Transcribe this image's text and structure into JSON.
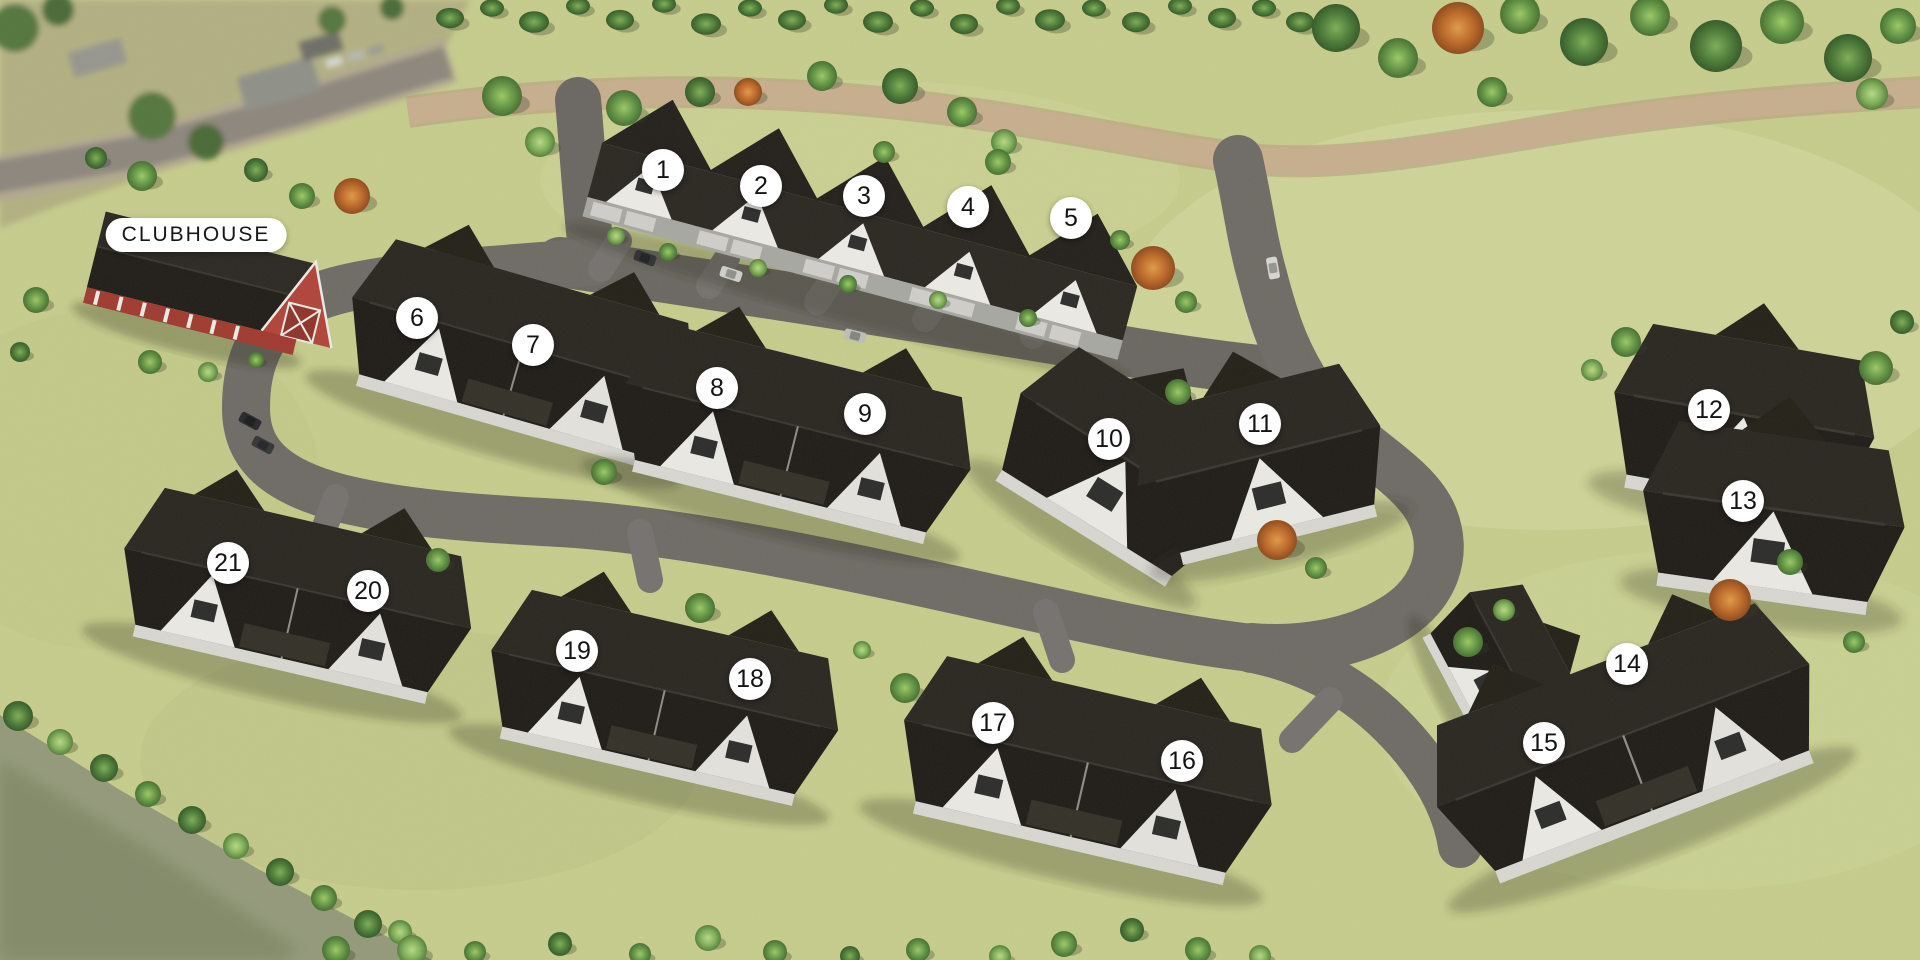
{
  "map_type": "residential-development-site-plan",
  "clubhouse": {
    "label": "CLUBHOUSE",
    "x": 196,
    "y": 235
  },
  "markers": [
    {
      "label": "1",
      "x": 663,
      "y": 170
    },
    {
      "label": "2",
      "x": 761,
      "y": 186
    },
    {
      "label": "3",
      "x": 864,
      "y": 196
    },
    {
      "label": "4",
      "x": 968,
      "y": 207
    },
    {
      "label": "5",
      "x": 1071,
      "y": 218
    },
    {
      "label": "6",
      "x": 417,
      "y": 318
    },
    {
      "label": "7",
      "x": 533,
      "y": 345
    },
    {
      "label": "8",
      "x": 717,
      "y": 388
    },
    {
      "label": "9",
      "x": 865,
      "y": 414
    },
    {
      "label": "10",
      "x": 1109,
      "y": 439
    },
    {
      "label": "11",
      "x": 1260,
      "y": 424
    },
    {
      "label": "12",
      "x": 1709,
      "y": 410
    },
    {
      "label": "13",
      "x": 1743,
      "y": 501
    },
    {
      "label": "14",
      "x": 1627,
      "y": 664
    },
    {
      "label": "15",
      "x": 1544,
      "y": 743
    },
    {
      "label": "16",
      "x": 1182,
      "y": 761
    },
    {
      "label": "17",
      "x": 993,
      "y": 723
    },
    {
      "label": "18",
      "x": 750,
      "y": 679
    },
    {
      "label": "19",
      "x": 577,
      "y": 651
    },
    {
      "label": "20",
      "x": 368,
      "y": 591
    },
    {
      "label": "21",
      "x": 228,
      "y": 563
    }
  ],
  "colors": {
    "grass": "#c6cc8d",
    "grass_light": "#d6dca4",
    "road_asphalt": "#6f6a66",
    "walking_path_tan": "#c7ae8e",
    "roof_dark": "#26221f",
    "house_wall_white": "#eae9e5",
    "garage_gray": "#a8a7a3",
    "barn_red": "#b0443a",
    "marker_bg": "#ffffff",
    "marker_text": "#141414",
    "tree_green": "#669946",
    "tree_autumn": "#c06b2a"
  }
}
